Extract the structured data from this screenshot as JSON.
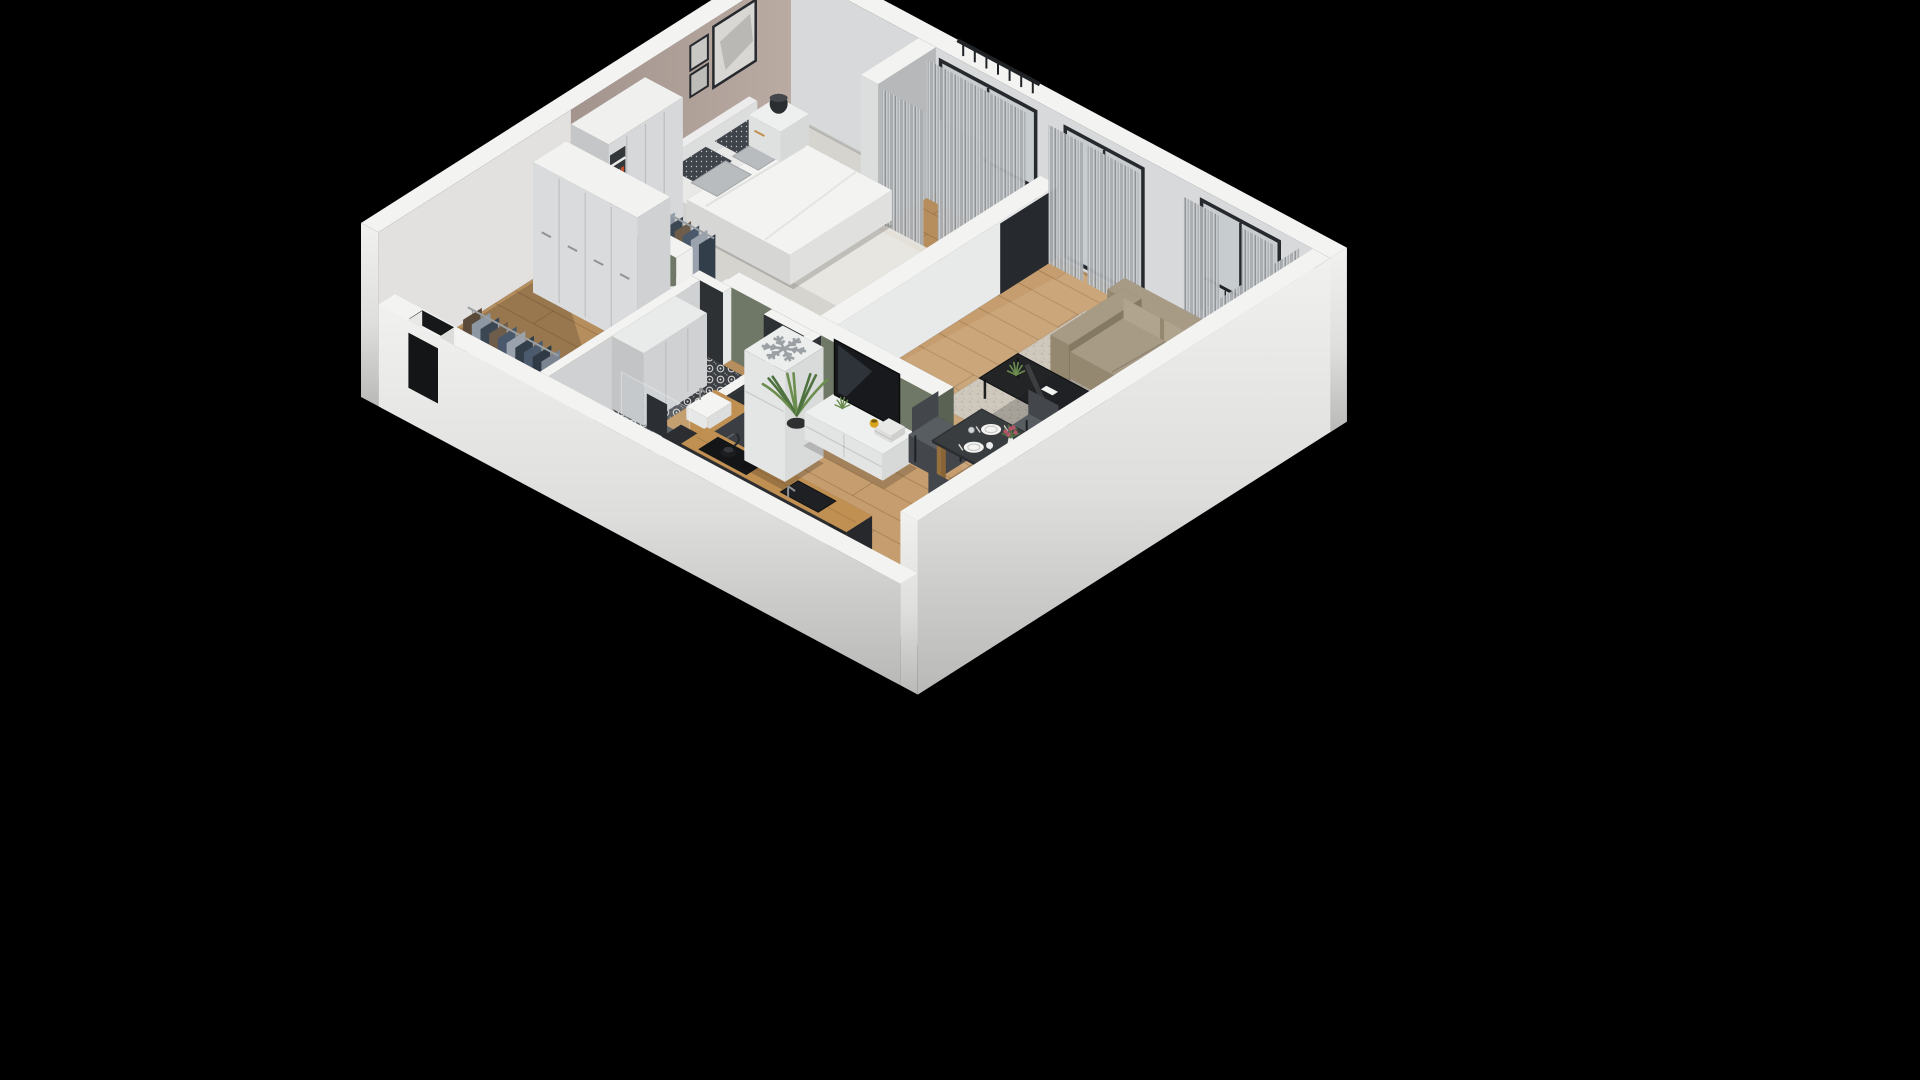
{
  "meta": {
    "title": "3D isometric cutaway floor plan render of a one-bedroom apartment on a black background",
    "background": "#000000"
  },
  "palette": {
    "background": "#000000",
    "wall_top": "#f3f3f2",
    "outer_light": "#f1f1f0",
    "outer_dark": "#b9b9b8",
    "ne_wall_face": "#d8d9da",
    "taupe_wall": "#b9aaa2",
    "taupe_wall_dark": "#a3948d",
    "sage_green": "#6f7866",
    "sage_green_dark": "#5a6253",
    "partition_grey": "#b6b8b9",
    "divider_white": "#e8e9e9",
    "wood_light": "#c59d6e",
    "wood_mid": "#b68e5e",
    "plank_line": "rgba(80,50,22,0.22)",
    "carpet": "#d6d4cf",
    "fluffy_rug": "#e8e7e3",
    "bed_white": "#f3f3f2",
    "bed_side": "#dededd",
    "pillow_dark": "#3f434a",
    "pillow_grey": "#b9bcbe",
    "furniture_white": "#eef0f0",
    "furniture_white_side": "#d7d9d9",
    "tv_black": "#17191c",
    "tv_reflect": "#343a41",
    "sofa_top": "#a89b86",
    "sofa_front": "#958871",
    "sofa_side": "#847963",
    "sofa_cushion": "#b1a48e",
    "rug_base": "#cdc7bc",
    "table_dark": "#3a3d40",
    "table_edge": "#2b2d30",
    "wood_leg": "#a87c48",
    "chair_grey": "#585d62",
    "chair_grey_dark": "#43474c",
    "dark_tile": "#2e3134",
    "dark_units": "#232527",
    "tile_floor_bg": "#3b3e43",
    "tile_motif": "#d3d3d1",
    "counter_wood": "#c08f52",
    "fridge_white": "#eceded",
    "fridge_icon": "#9aa0a3",
    "glass": "#c7ccce",
    "frame_dark": "#26292d",
    "railing": "#202326",
    "curtain_light": "#cdd0d2",
    "curtain_mid": "#a9adb0",
    "curtain_dark": "#8e9295",
    "plant_green": "#4f7340",
    "plant_green_light": "#6b8d4e",
    "pot_dark": "#2d2f31",
    "orange": "#e07a1e",
    "flower_pink": "#b2556a",
    "mug_yellow": "#d9a51e",
    "gold_handle": "#c28f4a",
    "shadow": "rgba(12,10,8,0.30)"
  },
  "scene": {
    "view": "isometric-cutaway",
    "rooms": [
      {
        "name": "bedroom",
        "floor": "grey-carpet",
        "furniture": [
          "double-bed",
          "headboard",
          "duvet",
          "pillows",
          "nightstand-left",
          "nightstand-right",
          "table-lamp",
          "potted-plant-small",
          "wardrobe",
          "wardrobe-open-shelf-books",
          "clothes-rail-bedroom",
          "picture-frame-large",
          "picture-frame-small",
          "fluffy-rug",
          "loggia-curtains",
          "balcony-railing"
        ]
      },
      {
        "name": "living-dining",
        "floor": "wood-planks",
        "furniture": [
          "corner-sofa",
          "coffee-table",
          "remote-control",
          "area-rug",
          "tv-stand",
          "tv",
          "books-stack",
          "yellow-mug",
          "plant-on-tv-stand",
          "palm-plant",
          "dining-table",
          "dining-chairs",
          "plates",
          "wine-glasses",
          "flower-vase",
          "fruit-bowl",
          "window-curtains",
          "french-balcony-door",
          "balcony-railing"
        ]
      },
      {
        "name": "kitchen",
        "floor": "wood-planks",
        "furniture": [
          "fridge-with-snowflake-icon",
          "kitchen-counter",
          "cooktop",
          "kettle",
          "kitchen-sink",
          "tap",
          "dark-tall-units"
        ]
      },
      {
        "name": "bathroom",
        "floor": "patterned-tile",
        "furniture": [
          "washing-machine-column",
          "vanity-cabinet",
          "vessel-sink",
          "shower",
          "shower-glass",
          "towel",
          "bathroom-door"
        ]
      },
      {
        "name": "hallway",
        "floor": "wood-planks",
        "furniture": [
          "tall-cabinets",
          "clothes-rail-entry",
          "entry-door-recess",
          "open-door-leaf"
        ]
      }
    ]
  }
}
